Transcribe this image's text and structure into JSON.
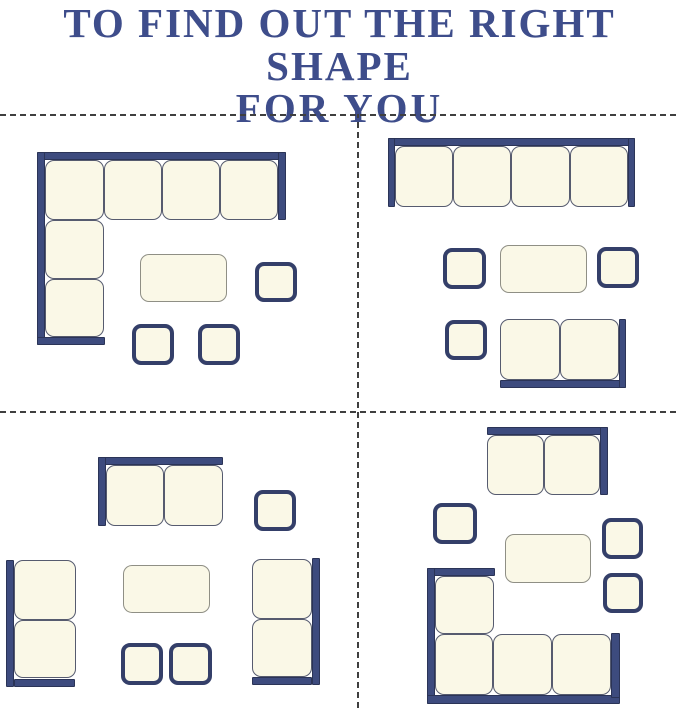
{
  "title": {
    "line1": "TO FIND OUT THE RIGHT SHAPE",
    "line2": "FOR YOU"
  },
  "colors": {
    "background": "#ffffff",
    "title_navy": "#3e4d8b",
    "bar_navy": "#3d4b7e",
    "bar_navy_dark": "#2b3457",
    "cushion_fill": "#faf8e7",
    "cushion_outline": "#565b6f",
    "table_outline": "#8f8f85",
    "ottoman_outline": "#343f69",
    "divider_gray": "#3f3f3f"
  },
  "canvas": {
    "width": 679,
    "height": 708
  },
  "dividers": [
    {
      "type": "h",
      "x": 0,
      "y": 114,
      "length": 679
    },
    {
      "type": "h",
      "x": 0,
      "y": 411,
      "length": 679
    },
    {
      "type": "v",
      "x": 357,
      "y": 114,
      "length": 594
    }
  ],
  "layouts": [
    {
      "id": "top-left",
      "label": "corner-sectional-set",
      "items": [
        {
          "name": "corner-sectional-sofa",
          "parts": [
            {
              "kind": "bar",
              "x": 37,
              "y": 152,
              "w": 249,
              "h": 8
            },
            {
              "kind": "bar",
              "x": 37,
              "y": 152,
              "w": 8,
              "h": 193
            },
            {
              "kind": "bar",
              "x": 37,
              "y": 337,
              "w": 68,
              "h": 8
            },
            {
              "kind": "bar",
              "x": 278,
              "y": 152,
              "w": 8,
              "h": 68
            },
            {
              "kind": "cushion",
              "x": 45,
              "y": 160,
              "w": 59,
              "h": 60
            },
            {
              "kind": "cushion",
              "x": 104,
              "y": 160,
              "w": 58,
              "h": 60
            },
            {
              "kind": "cushion",
              "x": 162,
              "y": 160,
              "w": 58,
              "h": 60
            },
            {
              "kind": "cushion",
              "x": 220,
              "y": 160,
              "w": 58,
              "h": 60
            },
            {
              "kind": "cushion",
              "x": 45,
              "y": 220,
              "w": 59,
              "h": 59
            },
            {
              "kind": "cushion",
              "x": 45,
              "y": 279,
              "w": 59,
              "h": 58
            }
          ]
        },
        {
          "name": "coffee-table",
          "parts": [
            {
              "kind": "table",
              "x": 140,
              "y": 254,
              "w": 87,
              "h": 48
            }
          ]
        },
        {
          "name": "side-ottoman",
          "parts": [
            {
              "kind": "ottoman",
              "x": 255,
              "y": 262,
              "w": 42,
              "h": 40
            }
          ]
        },
        {
          "name": "ottoman",
          "parts": [
            {
              "kind": "ottoman",
              "x": 132,
              "y": 324,
              "w": 42,
              "h": 41
            }
          ]
        },
        {
          "name": "ottoman",
          "parts": [
            {
              "kind": "ottoman",
              "x": 198,
              "y": 324,
              "w": 42,
              "h": 41
            }
          ]
        }
      ]
    },
    {
      "id": "top-right",
      "label": "straight-sofa-set",
      "items": [
        {
          "name": "four-seat-sofa",
          "parts": [
            {
              "kind": "bar",
              "x": 388,
              "y": 138,
              "w": 247,
              "h": 8
            },
            {
              "kind": "bar",
              "x": 388,
              "y": 138,
              "w": 7,
              "h": 69
            },
            {
              "kind": "bar",
              "x": 628,
              "y": 138,
              "w": 7,
              "h": 69
            },
            {
              "kind": "cushion",
              "x": 395,
              "y": 146,
              "w": 58,
              "h": 61
            },
            {
              "kind": "cushion",
              "x": 453,
              "y": 146,
              "w": 58,
              "h": 61
            },
            {
              "kind": "cushion",
              "x": 511,
              "y": 146,
              "w": 59,
              "h": 61
            },
            {
              "kind": "cushion",
              "x": 570,
              "y": 146,
              "w": 58,
              "h": 61
            }
          ]
        },
        {
          "name": "side-ottoman",
          "parts": [
            {
              "kind": "ottoman",
              "x": 443,
              "y": 248,
              "w": 43,
              "h": 41
            }
          ]
        },
        {
          "name": "coffee-table",
          "parts": [
            {
              "kind": "table",
              "x": 500,
              "y": 245,
              "w": 87,
              "h": 48
            }
          ]
        },
        {
          "name": "side-ottoman",
          "parts": [
            {
              "kind": "ottoman",
              "x": 597,
              "y": 247,
              "w": 42,
              "h": 41
            }
          ]
        },
        {
          "name": "ottoman",
          "parts": [
            {
              "kind": "ottoman",
              "x": 445,
              "y": 320,
              "w": 42,
              "h": 40
            }
          ]
        },
        {
          "name": "loveseat",
          "parts": [
            {
              "kind": "bar",
              "x": 500,
              "y": 380,
              "w": 126,
              "h": 8
            },
            {
              "kind": "bar",
              "x": 619,
              "y": 319,
              "w": 7,
              "h": 69
            },
            {
              "kind": "cushion",
              "x": 500,
              "y": 319,
              "w": 60,
              "h": 61
            },
            {
              "kind": "cushion",
              "x": 560,
              "y": 319,
              "w": 59,
              "h": 61
            }
          ]
        }
      ]
    },
    {
      "id": "bottom-left",
      "label": "facing-loveseats-set",
      "items": [
        {
          "name": "loveseat",
          "parts": [
            {
              "kind": "bar",
              "x": 98,
              "y": 457,
              "w": 125,
              "h": 8
            },
            {
              "kind": "bar",
              "x": 98,
              "y": 457,
              "w": 8,
              "h": 69
            },
            {
              "kind": "cushion",
              "x": 106,
              "y": 465,
              "w": 58,
              "h": 61
            },
            {
              "kind": "cushion",
              "x": 164,
              "y": 465,
              "w": 59,
              "h": 61
            }
          ]
        },
        {
          "name": "side-ottoman",
          "parts": [
            {
              "kind": "ottoman",
              "x": 254,
              "y": 490,
              "w": 42,
              "h": 41
            }
          ]
        },
        {
          "name": "left-loveseat",
          "parts": [
            {
              "kind": "bar",
              "x": 6,
              "y": 560,
              "w": 8,
              "h": 127
            },
            {
              "kind": "bar",
              "x": 14,
              "y": 679,
              "w": 61,
              "h": 8
            },
            {
              "kind": "cushion",
              "x": 14,
              "y": 560,
              "w": 62,
              "h": 60
            },
            {
              "kind": "cushion",
              "x": 14,
              "y": 620,
              "w": 62,
              "h": 58
            }
          ]
        },
        {
          "name": "coffee-table",
          "parts": [
            {
              "kind": "table",
              "x": 123,
              "y": 565,
              "w": 87,
              "h": 48
            }
          ]
        },
        {
          "name": "ottoman",
          "parts": [
            {
              "kind": "ottoman",
              "x": 121,
              "y": 643,
              "w": 42,
              "h": 42
            }
          ]
        },
        {
          "name": "ottoman",
          "parts": [
            {
              "kind": "ottoman",
              "x": 169,
              "y": 643,
              "w": 43,
              "h": 42
            }
          ]
        },
        {
          "name": "right-loveseat",
          "parts": [
            {
              "kind": "bar",
              "x": 312,
              "y": 558,
              "w": 8,
              "h": 127
            },
            {
              "kind": "bar",
              "x": 252,
              "y": 677,
              "w": 60,
              "h": 8
            },
            {
              "kind": "cushion",
              "x": 252,
              "y": 559,
              "w": 60,
              "h": 60
            },
            {
              "kind": "cushion",
              "x": 252,
              "y": 619,
              "w": 60,
              "h": 58
            }
          ]
        }
      ]
    },
    {
      "id": "bottom-right",
      "label": "sectional-with-loveseat-set",
      "items": [
        {
          "name": "loveseat",
          "parts": [
            {
              "kind": "bar",
              "x": 487,
              "y": 427,
              "w": 121,
              "h": 8
            },
            {
              "kind": "bar",
              "x": 600,
              "y": 427,
              "w": 8,
              "h": 68
            },
            {
              "kind": "cushion",
              "x": 487,
              "y": 435,
              "w": 57,
              "h": 60
            },
            {
              "kind": "cushion",
              "x": 544,
              "y": 435,
              "w": 56,
              "h": 60
            }
          ]
        },
        {
          "name": "side-ottoman",
          "parts": [
            {
              "kind": "ottoman",
              "x": 433,
              "y": 503,
              "w": 44,
              "h": 41
            }
          ]
        },
        {
          "name": "coffee-table",
          "parts": [
            {
              "kind": "table",
              "x": 505,
              "y": 534,
              "w": 86,
              "h": 49
            }
          ]
        },
        {
          "name": "side-ottoman",
          "parts": [
            {
              "kind": "ottoman",
              "x": 602,
              "y": 518,
              "w": 41,
              "h": 41
            }
          ]
        },
        {
          "name": "side-ottoman",
          "parts": [
            {
              "kind": "ottoman",
              "x": 603,
              "y": 573,
              "w": 40,
              "h": 40
            }
          ]
        },
        {
          "name": "corner-sectional-sofa",
          "parts": [
            {
              "kind": "bar",
              "x": 427,
              "y": 568,
              "w": 68,
              "h": 8
            },
            {
              "kind": "bar",
              "x": 427,
              "y": 568,
              "w": 8,
              "h": 136
            },
            {
              "kind": "bar",
              "x": 427,
              "y": 695,
              "w": 193,
              "h": 9
            },
            {
              "kind": "bar",
              "x": 611,
              "y": 633,
              "w": 9,
              "h": 65
            },
            {
              "kind": "cushion",
              "x": 435,
              "y": 576,
              "w": 59,
              "h": 58
            },
            {
              "kind": "cushion",
              "x": 435,
              "y": 634,
              "w": 58,
              "h": 61
            },
            {
              "kind": "cushion",
              "x": 493,
              "y": 634,
              "w": 59,
              "h": 61
            },
            {
              "kind": "cushion",
              "x": 552,
              "y": 634,
              "w": 59,
              "h": 61
            }
          ]
        }
      ]
    }
  ]
}
